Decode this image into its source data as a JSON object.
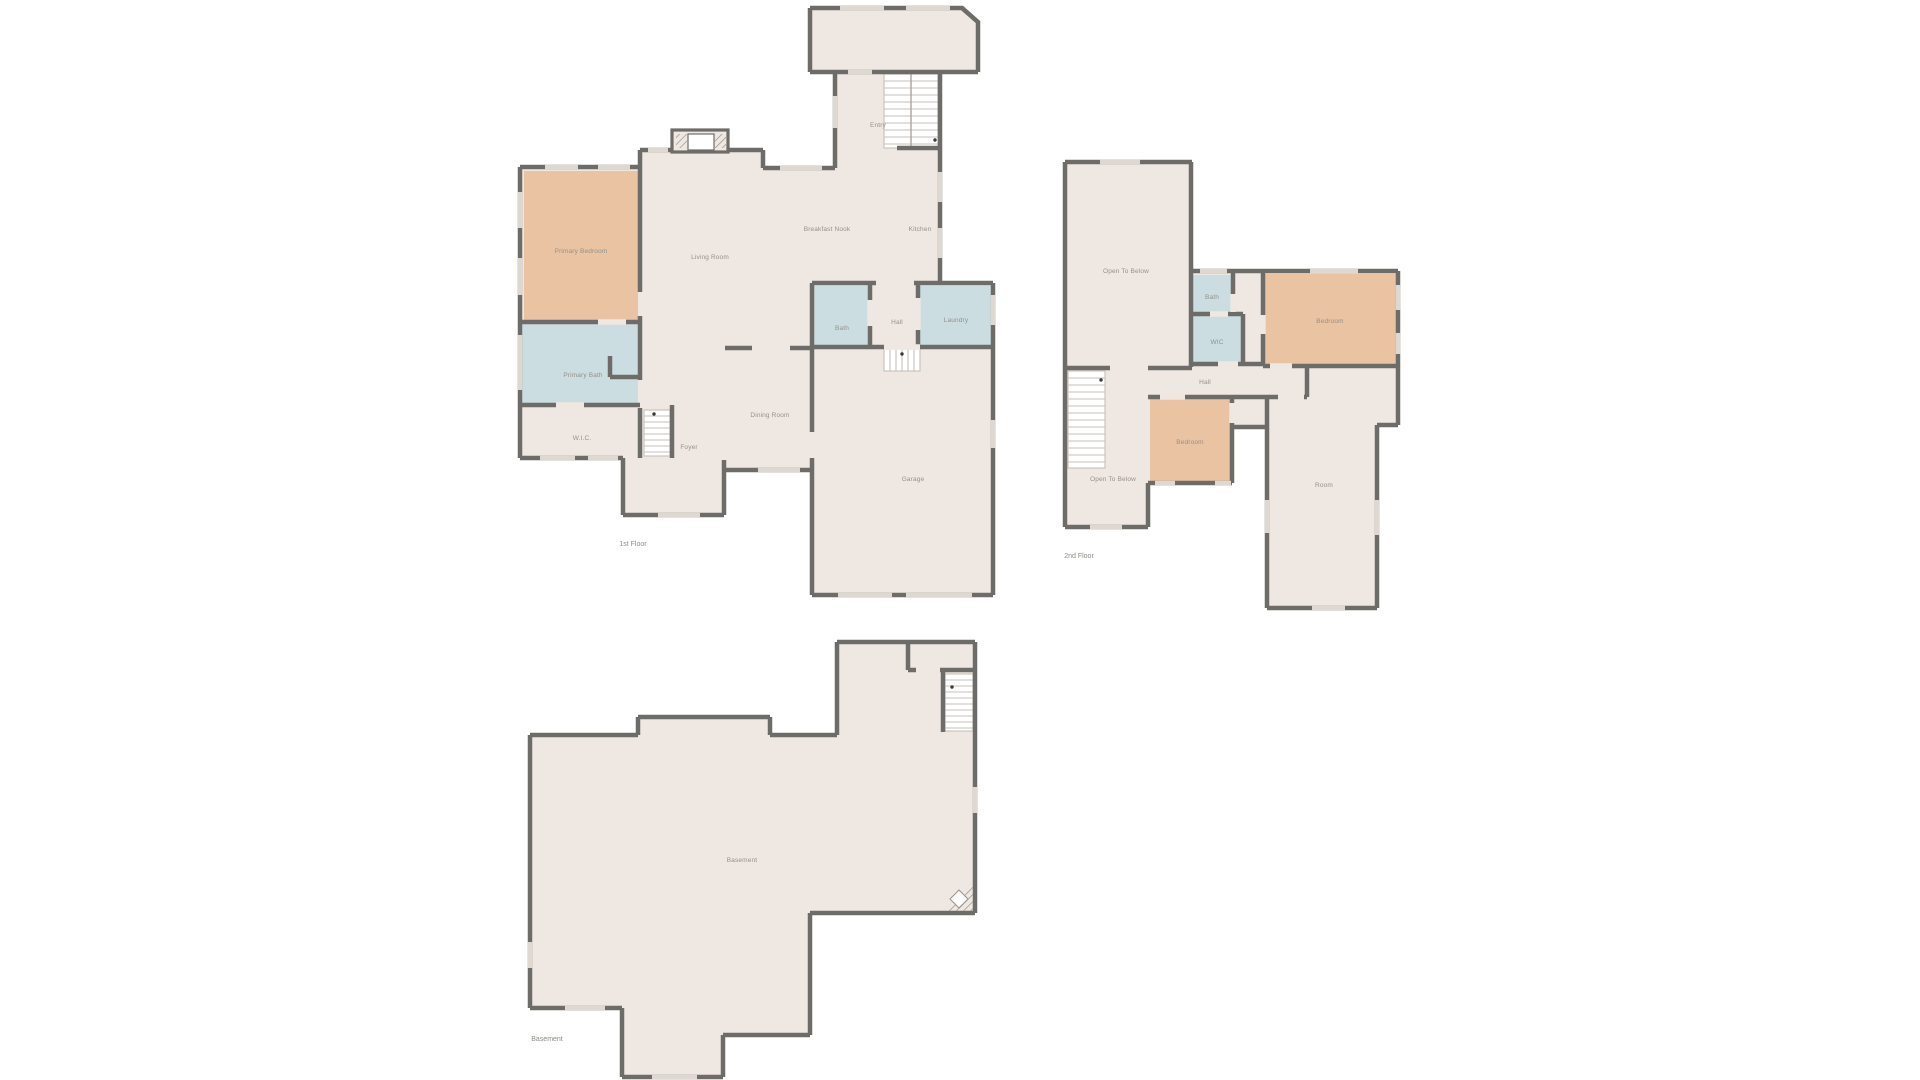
{
  "palette": {
    "background": "#ffffff",
    "floor_fill": "#efe8e2",
    "wall": "#6e6c68",
    "bedroom_fill": "#eac3a2",
    "bath_fill": "#cbdde1",
    "window": "#ded8d1",
    "stair_line": "#c6c1ba",
    "hatch": "#97928b",
    "label_text": "#95908a"
  },
  "floors": {
    "first": {
      "caption": "1st Floor",
      "rooms": {
        "primary_bedroom": "Primary Bedroom",
        "primary_bath": "Primary Bath",
        "wic": "W.I.C.",
        "living_room": "Living Room",
        "breakfast_nook": "Breakfast Nook",
        "kitchen": "Kitchen",
        "entry": "Entry",
        "foyer": "Foyer",
        "dining_room": "Dining Room",
        "bath": "Bath",
        "hall": "Hall",
        "laundry": "Laundry",
        "garage": "Garage"
      }
    },
    "second": {
      "caption": "2nd Floor",
      "rooms": {
        "open_to_below_upper": "Open To Below",
        "bath": "Bath",
        "wic": "WIC",
        "bedroom_upper": "Bedroom",
        "hall": "Hall",
        "open_to_below_lower": "Open To Below",
        "bedroom_lower": "Bedroom",
        "room": "Room"
      }
    },
    "basement": {
      "caption": "Basement",
      "rooms": {
        "basement": "Basement"
      }
    }
  }
}
